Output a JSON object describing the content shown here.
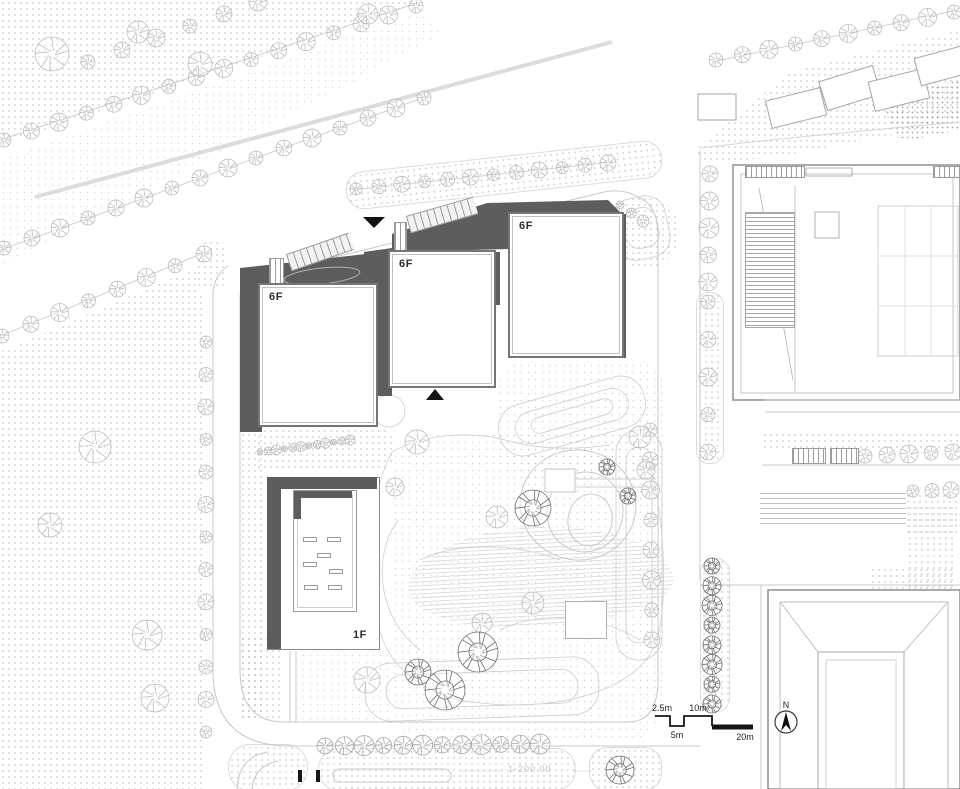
{
  "title": "architectural site plan",
  "buildings": {
    "tower_left": {
      "label": "6F"
    },
    "tower_middle": {
      "label": "6F"
    },
    "tower_right": {
      "label": "6F"
    },
    "podium_hall": {
      "label": "1F"
    }
  },
  "scale_bar": {
    "labels": [
      "2.5m",
      "5m",
      "10m",
      "20m"
    ]
  },
  "compass": {
    "label": "N"
  },
  "annotations": {
    "level_note": "1-200.00"
  },
  "colors": {
    "podium_dark": "#5d5d5d",
    "building_outline": "#767676",
    "line_light": "#c9c9c9",
    "marker_black": "#141414"
  }
}
